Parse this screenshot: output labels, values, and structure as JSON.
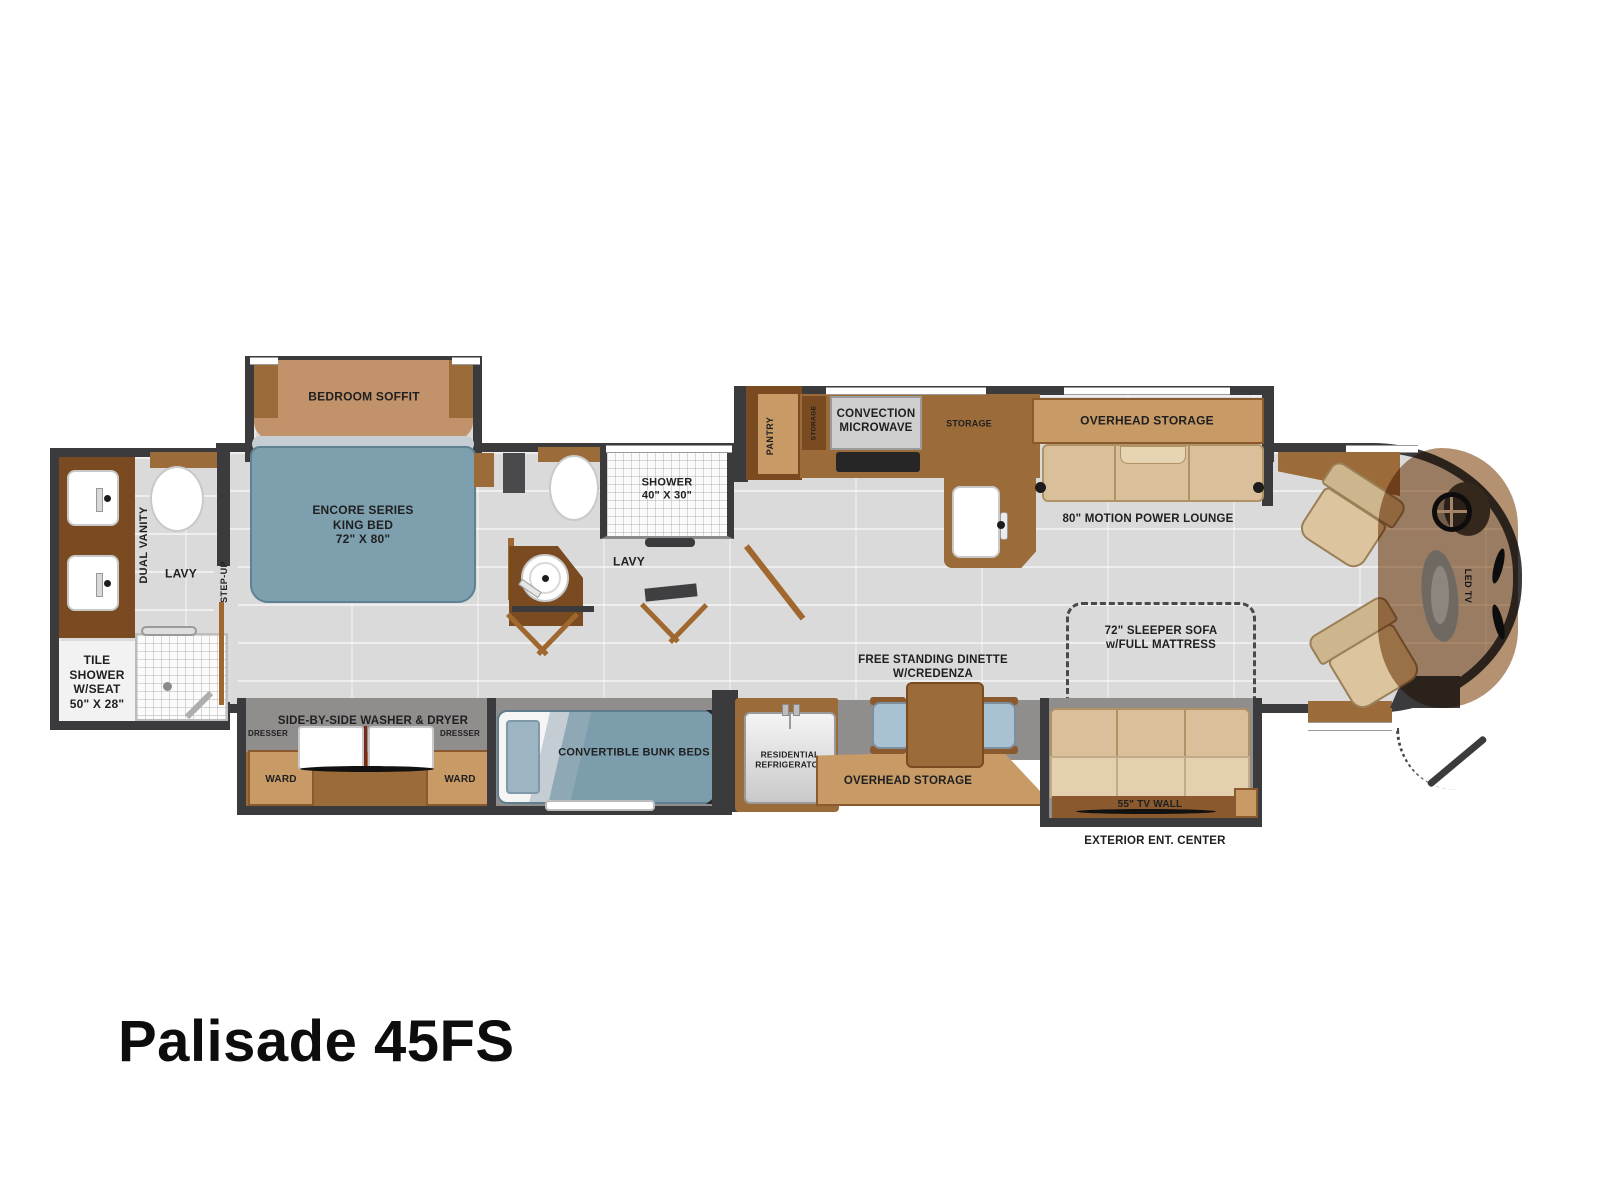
{
  "title": "Palisade 45FS",
  "colors": {
    "wall": "#3b3b3d",
    "floor": "#dadada",
    "slide_interior": "#908e8d",
    "cabinet_dark": "#7a4a21",
    "cabinet_mid": "#9c6b3a",
    "cabinet_light": "#c79a66",
    "bed_blue": "#7d9fae",
    "sofa_tan": "#d9c09a",
    "accent_line": "#a0672f"
  },
  "rear_bath": {
    "dual_vanity": "DUAL VANITY",
    "lavy": "LAVY",
    "tile_shower_lines": [
      "TILE",
      "SHOWER",
      "W/SEAT",
      "50\" X 28\""
    ]
  },
  "hallway": {
    "step_up": "STEP-UP"
  },
  "bedroom": {
    "soffit": "BEDROOM SOFFIT",
    "bed_lines": [
      "ENCORE SERIES",
      "KING BED",
      "72\"  X  80\""
    ]
  },
  "mid_bath": {
    "shower_lines": [
      "SHOWER",
      "40\" X 30\""
    ],
    "lavy": "LAVY"
  },
  "kitchen": {
    "pantry": "PANTRY",
    "storage_upper": "STORAGE",
    "microwave_lines": [
      "CONVECTION",
      "MICROWAVE"
    ],
    "storage": "STORAGE"
  },
  "living": {
    "overhead_storage_top": "OVERHEAD STORAGE",
    "power_lounge": "80\" MOTION POWER LOUNGE",
    "sleeper_lines": [
      "72\" SLEEPER SOFA",
      "w/FULL MATTRESS"
    ],
    "dinette_lines": [
      "FREE STANDING DINETTE",
      "W/CREDENZA"
    ],
    "overhead_storage_bottom": "OVERHEAD STORAGE",
    "tv_wall": "55\" TV WALL",
    "exterior_ent_center": "EXTERIOR ENT. CENTER"
  },
  "bunk_room": {
    "washer_dryer": "SIDE-BY-SIDE WASHER & DRYER",
    "dresser_left": "DRESSER",
    "dresser_right": "DRESSER",
    "ward_left": "WARD",
    "ward_right": "WARD",
    "bunk_beds": "CONVERTIBLE BUNK BEDS",
    "refrigerator_lines": [
      "RESIDENTIAL",
      "REFRIGERATOR"
    ]
  },
  "cab": {
    "led_tv": "LED TV"
  }
}
